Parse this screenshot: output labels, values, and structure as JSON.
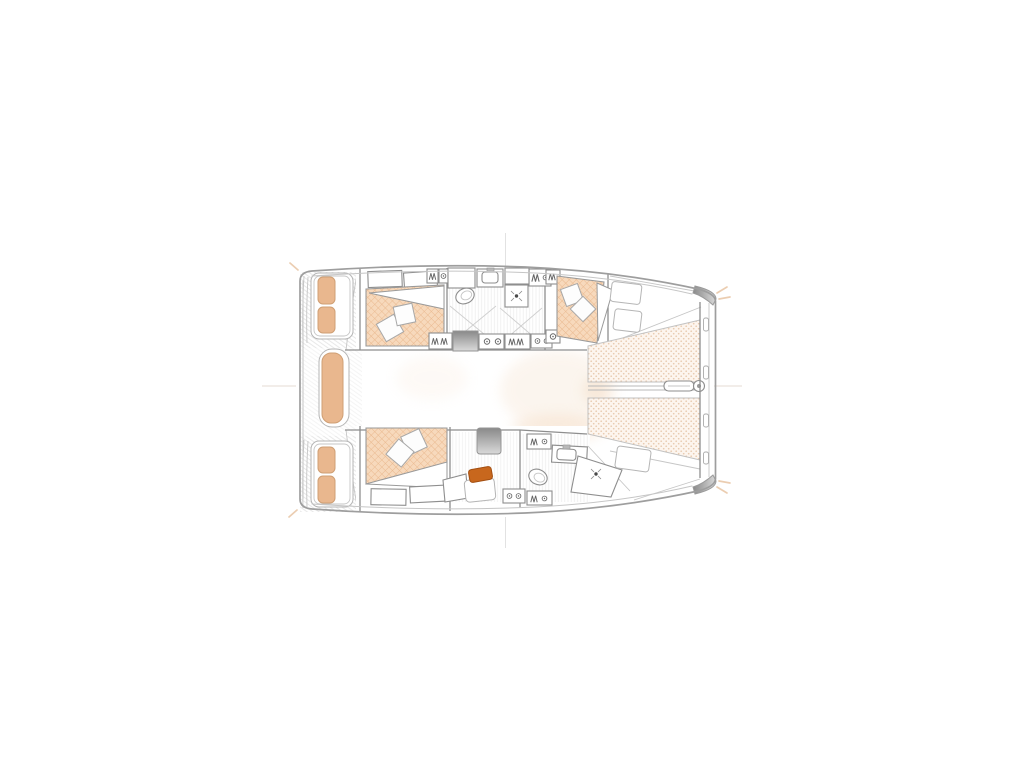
{
  "canvas": {
    "width": 1024,
    "height": 768,
    "background": "#ffffff"
  },
  "diagram": {
    "kind": "catamaran-interior-deck-plan",
    "orientation": "bow-right",
    "rooms": {
      "port_hull": [
        "aft-double-cabin",
        "bathroom",
        "forward-double-cabin"
      ],
      "starboard_hull": [
        "aft-double-cabin",
        "desk-area",
        "bathroom"
      ],
      "deck": [
        "stern-platforms",
        "cockpit-bench-seats",
        "bow-trampolines",
        "bowsprit-anchor-fitting"
      ]
    }
  },
  "colors": {
    "background": "#ffffff",
    "outline": "#9e9e9e",
    "outline_light": "#c6c6c6",
    "wall": "#8e8e8e",
    "deck_line": "#dcdcdc",
    "floor_line": "#e0e0e0",
    "mattress_fill": "#f7d9bc",
    "mattress_hatch": "#e9b88e",
    "cushion": "#e9b78e",
    "cushion_edge": "#cf9f74",
    "trampoline_fill": "#fdf5ee",
    "trampoline_dot": "#e8cbb0",
    "steps_dark": "#898989",
    "steps_light": "#dadada",
    "chair": "#c8671d",
    "chair_edge": "#a34f12",
    "glow": "#f4dcc4",
    "centerline": "#e6dbd3",
    "mark_gray": "#e2e2e2",
    "tan_accent": "#e8c5a4",
    "glyph": "#666666",
    "metal": "#b9b9b9"
  }
}
